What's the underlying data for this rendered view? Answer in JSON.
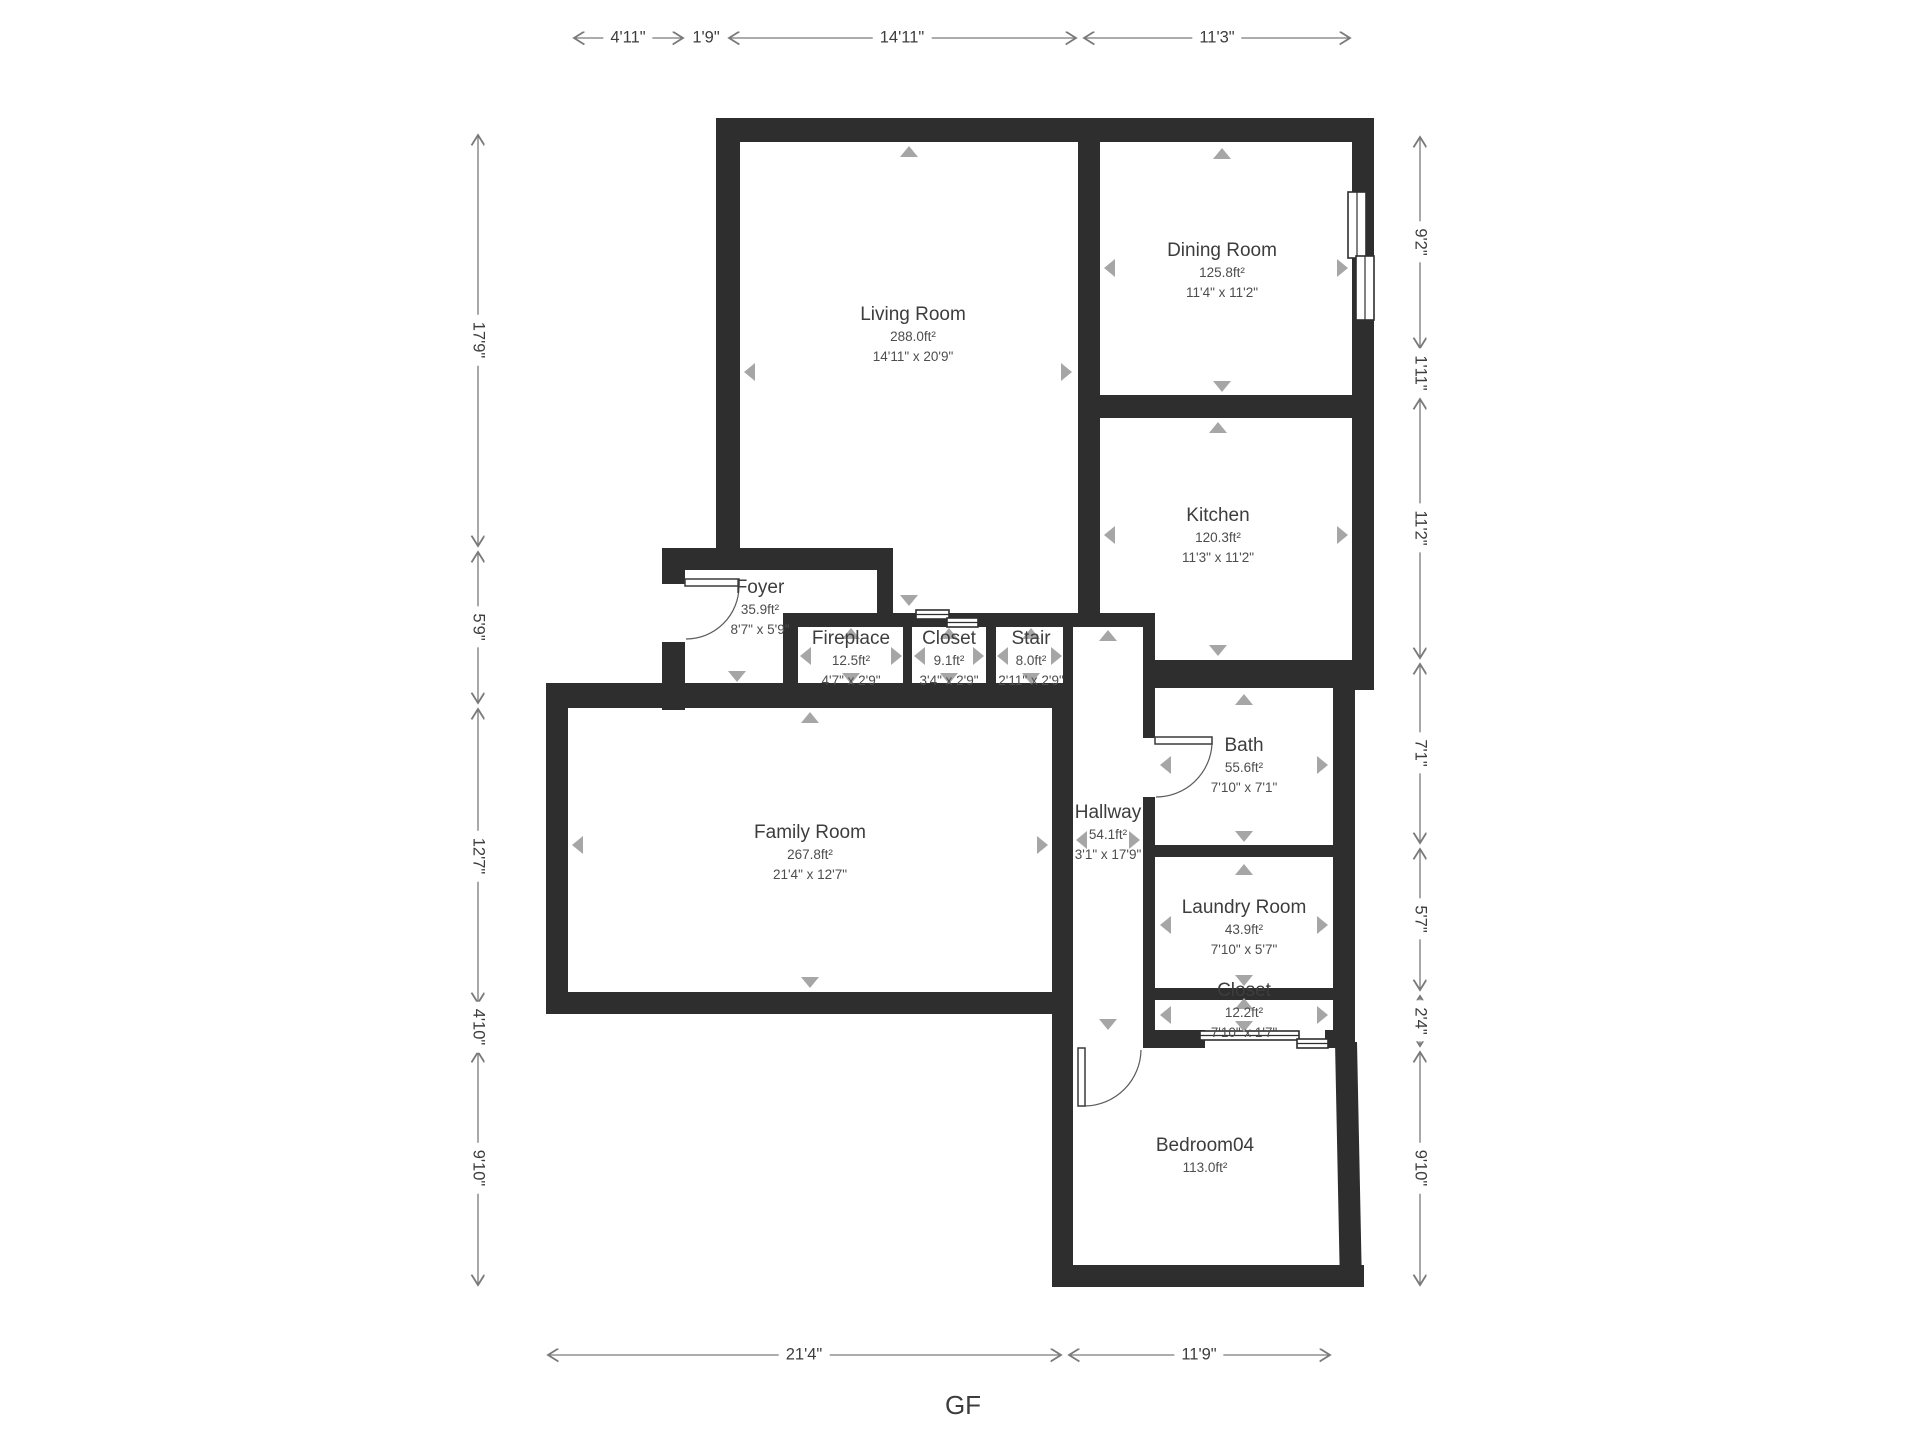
{
  "title": "GF",
  "rooms": [
    {
      "name": "Living Room",
      "area": "288.0ft²",
      "dims": "14'11\" x 20'9\""
    },
    {
      "name": "Dining Room",
      "area": "125.8ft²",
      "dims": "11'4\" x 11'2\""
    },
    {
      "name": "Kitchen",
      "area": "120.3ft²",
      "dims": "11'3\" x 11'2\""
    },
    {
      "name": "Foyer",
      "area": "35.9ft²",
      "dims": "8'7\" x 5'9\""
    },
    {
      "name": "Fireplace",
      "area": "12.5ft²",
      "dims": "4'7\" x 2'9\""
    },
    {
      "name": "Closet",
      "area": "9.1ft²",
      "dims": "3'4\" x 2'9\""
    },
    {
      "name": "Stair",
      "area": "8.0ft²",
      "dims": "2'11\" x 2'9\""
    },
    {
      "name": "Bath",
      "area": "55.6ft²",
      "dims": "7'10\" x 7'1\""
    },
    {
      "name": "Hallway",
      "area": "54.1ft²",
      "dims": "3'1\" x 17'9\""
    },
    {
      "name": "Family Room",
      "area": "267.8ft²",
      "dims": "21'4\" x 12'7\""
    },
    {
      "name": "Laundry Room",
      "area": "43.9ft²",
      "dims": "7'10\" x 5'7\""
    },
    {
      "name": "Closet",
      "area": "12.2ft²",
      "dims": "7'10\" x 1'7\""
    },
    {
      "name": "Bedroom04",
      "area": "113.0ft²",
      "dims": ""
    }
  ],
  "dimensions": {
    "top": [
      "4'11\"",
      "1'9\"",
      "14'11\"",
      "11'3\""
    ],
    "left": [
      "17'9\"",
      "5'9\"",
      "12'7\"",
      "4'10\"",
      "9'10\""
    ],
    "right": [
      "9'2\"",
      "1'11\"",
      "11'2\"",
      "7'1\"",
      "5'7\"",
      "2'4\"",
      "9'10\""
    ],
    "bottom": [
      "21'4\"",
      "11'9\""
    ]
  },
  "colors": {
    "wall": "#2e2e2e",
    "dimension_line": "#7a7a7a",
    "label_text": "#3d3d3d",
    "direction_arrow": "#a6a6a6"
  }
}
